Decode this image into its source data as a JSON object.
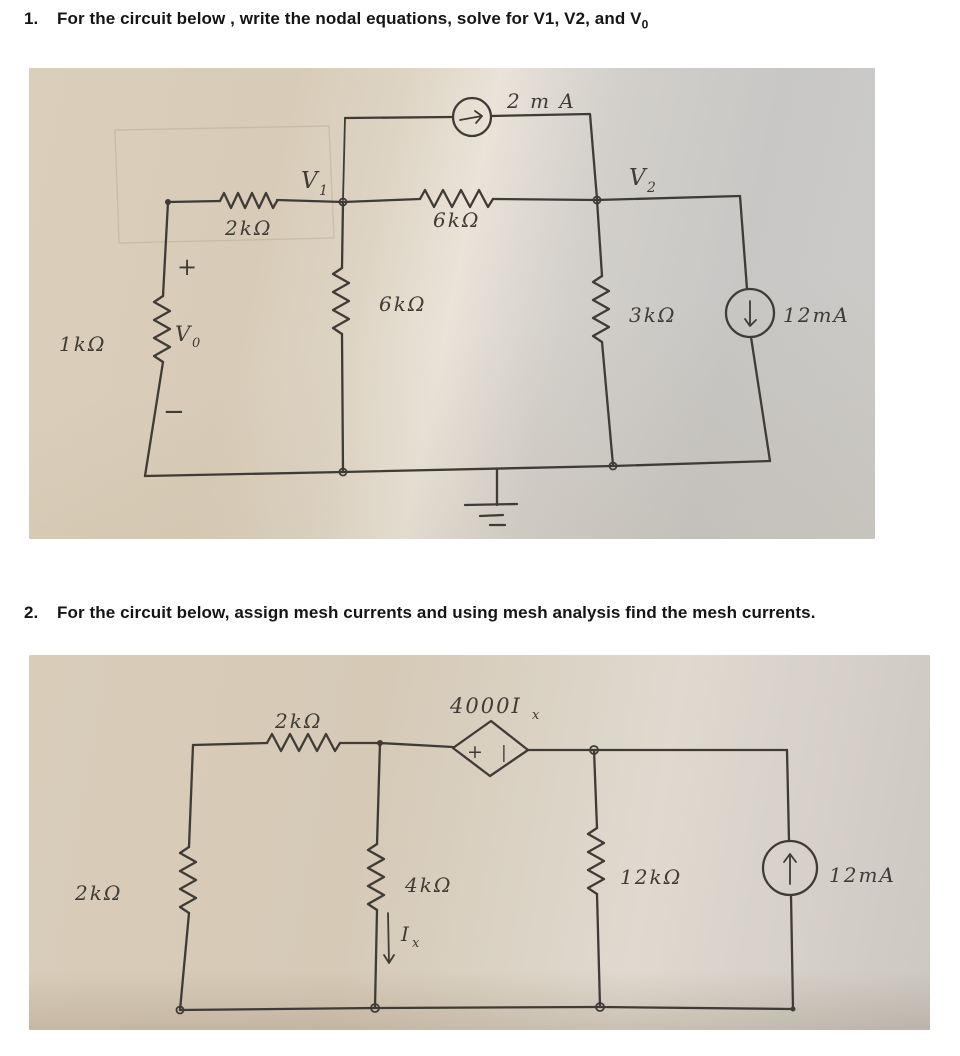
{
  "problems": [
    {
      "number": "1.",
      "text": "For the circuit below , write the nodal equations, solve for V1, V2, and V",
      "subscript": "0"
    },
    {
      "number": "2.",
      "text": "For the circuit below, assign mesh currents and using mesh analysis find the mesh currents."
    }
  ],
  "circuit1": {
    "top_source_label": "2 m A",
    "v1": {
      "main": "V",
      "sub": "1"
    },
    "v2": {
      "main": "V",
      "sub": "2"
    },
    "v0": {
      "main": "V",
      "sub": "0"
    },
    "r2k": "2kΩ",
    "r6k_horizontal": "6kΩ",
    "r6k_vertical": "6kΩ",
    "r3k": "3kΩ",
    "r1k": "1kΩ",
    "plus": "+",
    "minus": "−",
    "right_source_label": "12mA"
  },
  "circuit2": {
    "r2k_top": "2kΩ",
    "dep_source_label": {
      "main": "4000I",
      "sub": "x"
    },
    "dep_source_plus": "+",
    "dep_source_bar": "|",
    "r2k_left": "2kΩ",
    "r4k": "4kΩ",
    "ix": {
      "main": "I",
      "sub": "x"
    },
    "r12k": "12kΩ",
    "source_label": "12mA"
  },
  "colors": {
    "ink": "#3f3b36",
    "paper_beige": "#d8ccb8",
    "paper_gray": "#c8c7c5"
  }
}
